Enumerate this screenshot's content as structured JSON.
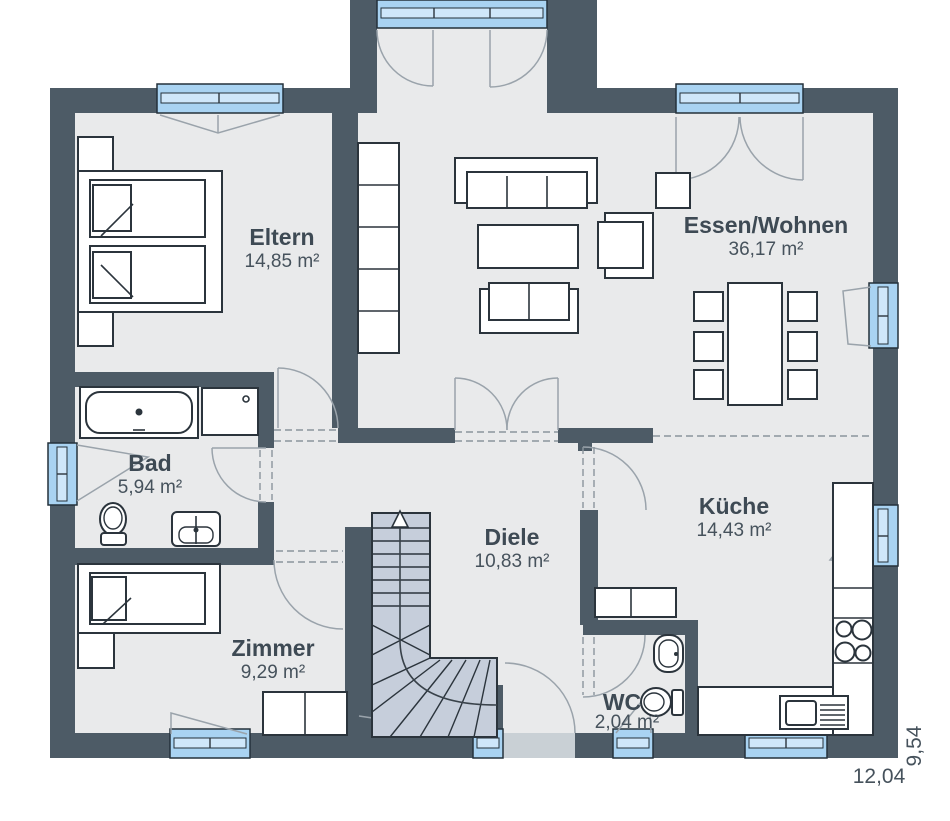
{
  "plan": {
    "rooms": {
      "eltern": {
        "name": "Eltern",
        "area": "14,85 m²"
      },
      "essen_wohnen": {
        "name": "Essen/Wohnen",
        "area": "36,17 m²"
      },
      "bad": {
        "name": "Bad",
        "area": "5,94 m²"
      },
      "diele": {
        "name": "Diele",
        "area": "10,83 m²"
      },
      "kueche": {
        "name": "Küche",
        "area": "14,43 m²"
      },
      "zimmer": {
        "name": "Zimmer",
        "area": "9,29 m²"
      },
      "wc": {
        "name": "WC",
        "area": "2,04 m²"
      }
    },
    "dimensions": {
      "width_label": "12,04",
      "depth_label": "9,54"
    },
    "colors": {
      "wall": "#4d5b66",
      "floor": "#e9eaeb",
      "window_glass": "#a9d3f2",
      "stair": "#c6cedb",
      "entrance_slab": "#c9d0d5",
      "label_text": "#3e4a54"
    }
  }
}
